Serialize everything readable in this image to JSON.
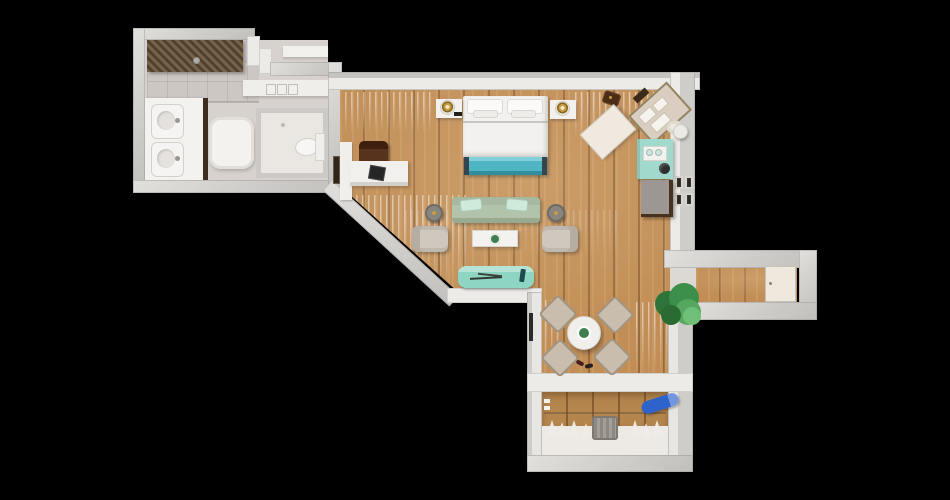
{
  "scene": {
    "type": "floor-plan-3d-top-view",
    "description": "Top-down 3D rendered floor plan of a studio suite on a black background",
    "background": "#000000"
  },
  "palette": {
    "background": "#000000",
    "wall_light": "#dedcd9",
    "wall_edge": "#bfbdba",
    "wall_white_face": "#edebe8",
    "wood_floor": "#c28e56",
    "plank_line": "#76502a",
    "bathroom_floor": "#d8d2ce",
    "white_furniture": "#f2f0ed",
    "teal_bed_bench": "#4fb5c3",
    "mint_window_bench": "#8fd5c3",
    "sage_sofa": "#b2c3ab",
    "mint_pillow": "#cfe9da",
    "minibar_teal": "#a2d9cd",
    "armchair_beige": "#cfc8be",
    "dining_chair_tan": "#c9bead",
    "desk_chair_brown": "#58331d",
    "brass_lamp": "#c79b3f",
    "plant_green": "#3c8f4b",
    "ironing_board_blue": "#2f63cc",
    "dresser_gray": "#9c9792",
    "dark_wood_trim": "#46321f",
    "shower_slats": "#6b5940"
  },
  "rooms": {
    "bathroom": "Bathroom with double vanity and walk-in shower",
    "wc": "Separate WC",
    "main": "Bedroom and living area",
    "dining": "Dining area",
    "hallway": "Entry hallway",
    "closet": "Wardrobe closet with hangers and ironing board"
  },
  "furniture": {
    "bed": "Double bed with pillows",
    "bed_bench": "Teal bench at foot of bed",
    "nightstand_left": "Left nightstand",
    "nightstand_right": "Right nightstand",
    "lamp_left": "Brass table lamp",
    "lamp_right": "Brass table lamp",
    "desk": "Work desk",
    "laptop": "Laptop",
    "desk_chair": "Brown desk chair",
    "door_main": "Door to bathroom corridor",
    "wall_art": "Recessed wall panel",
    "sofa": "Sage green sofa with mint cushions",
    "side_table_left": "Round side table",
    "side_table_right": "Round side table",
    "armchair_left": "Beige armchair",
    "armchair_right": "Beige armchair",
    "coffee_table": "White coffee table with plant dish",
    "window_bench": "Mint window bench with sunglasses",
    "dining_table": "Round dining table with centerpiece",
    "dining_chair": "Dining chair",
    "slippers": "Slippers",
    "plant": "Potted green plant",
    "luggage_pad": "Folding luggage bench",
    "suitcase_tray": "Open suitcase tray",
    "travel_bag": "Travel bag",
    "hat": "Sun hat",
    "stool": "Small round stool",
    "minibar": "Teal minibar cabinet with coffee tray and kettle",
    "dresser": "Gray dresser with dark wood trim",
    "gallery_frames": "Four framed pictures on wall",
    "vanity": "Double sink vanity",
    "shower": "Walk-in shower with slatted canopy",
    "shower_tray": "Shower tray",
    "toilet": "Toilet",
    "bath_shelf": "Bathroom shelf",
    "bath_ledge": "Bathroom ledge with towels",
    "hangers": "Clothes hangers",
    "basket": "Laundry basket",
    "ironing_board": "Blue ironing board",
    "entry_door": "Entry door",
    "threshold": "Hallway threshold"
  }
}
